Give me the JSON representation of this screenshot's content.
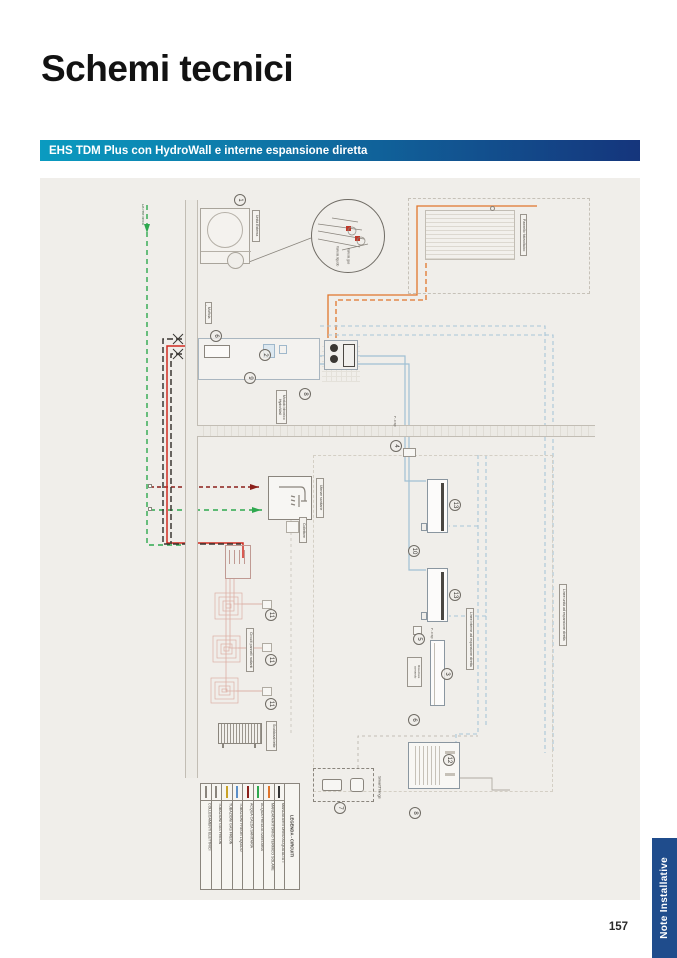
{
  "page": {
    "title": "Schemi tecnici",
    "number": "157"
  },
  "banner": {
    "label": "EHS TDM Plus con HydroWall e interne espansione diretta",
    "gradient_from": "#0a9bc0",
    "gradient_to": "#15357c"
  },
  "side_tab": {
    "label": "Note Installative",
    "color": "#1f4c8c"
  },
  "diagram": {
    "bg": "#f0eeea",
    "labels": {
      "water_mains": "Da rete idrica",
      "outdoor_unit": "Unità Esterna",
      "junction_box": "Muffola derivazione",
      "solar_panel": "Pannello fotovoltaico",
      "hydro_module": "Modulo idronico HydroWall",
      "sanitary": "Utenze sanitarie",
      "manifold": "Collettore",
      "radiant": "Circuiti pannelli radianti",
      "towel_rail": "Scaldasalviette",
      "smart_things": "SmartThings",
      "dx_lines": "Linee interne ad espansione diretta",
      "dx_units": "Linee unità ad espansione diretta",
      "receiver": "Ricevitore comando",
      "p_trap": "P-Trap",
      "p_trap2": "P-Trap",
      "valve_gas": "Valvola gas",
      "valve_liquid": "Valvola liquido"
    },
    "badges": [
      "1",
      "6",
      "2",
      "9",
      "8",
      "4",
      "10",
      "13",
      "13",
      "3",
      "5",
      "6",
      "11",
      "11",
      "11",
      "7",
      "12",
      "8"
    ],
    "legend": {
      "title": "LEGENDA - CIRCUITI",
      "entries": [
        {
          "label": "COLLEGAMENTI ELETTRICI",
          "color": "#8a857d",
          "style": "solid"
        },
        {
          "label": "TUBAZIONI GAS FREON",
          "color": "#8a857d",
          "style": "solid"
        },
        {
          "label": "TUBAZIONI GAS FREON",
          "color": "#c9a227",
          "style": "dashed"
        },
        {
          "label": "TUBAZIONI FREON LIQUIDO",
          "color": "#5b8fc9",
          "style": "solid"
        },
        {
          "label": "ACQUA CALDA SANITARIA",
          "color": "#8b1f1a",
          "style": "dashed"
        },
        {
          "label": "ACQUA FREDDA SANITARIA",
          "color": "#2ea84e",
          "style": "dashed"
        },
        {
          "label": "MANDATA/RITORNO TERMICO SOLARE",
          "color": "#e0762c",
          "style": "solid"
        },
        {
          "label": "MANDATA/RITORNO ACQUA ALTA T",
          "color": "#333333",
          "style": "dashed"
        }
      ]
    }
  }
}
